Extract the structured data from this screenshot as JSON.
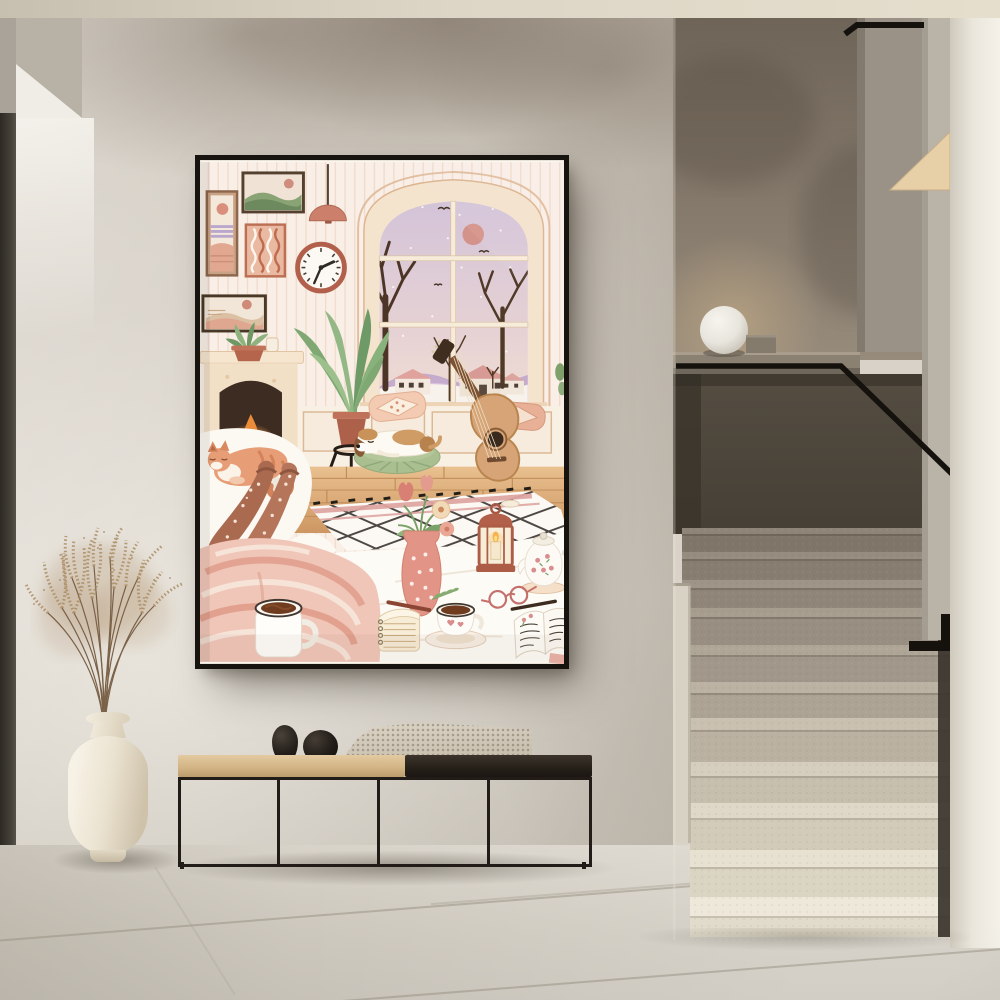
{
  "meta": {
    "description": "Interior hallway photograph: black-framed cozy living-room illustration hanging on a plaster wall above a metal bench, cream vase with dried pampas grass, and a terrazzo staircase with black handrail and white globe lamp"
  },
  "palette": {
    "wall": "#d8d2c9",
    "soffitGrey": "#b7b1a6",
    "soffitWhite": "#f0ede6",
    "doorFrame": "#3b382f",
    "ceiling": "#ddd5c5",
    "frame": "#17140f",
    "artBase": "#faf6ef",
    "artPink": "#e8a898",
    "artTerracotta": "#bd6f54",
    "artGreen": "#7fa873",
    "artPurple": "#c9b7d8",
    "artBrown": "#8a5c38",
    "stairUpperWall": "#75695c",
    "stairPanel": "#4b443a",
    "ledge": "#8b8173",
    "lampWhite": "#f2efe9",
    "handrail": "#16130f",
    "stepDark": "#7f7568",
    "stepLight": "#ede8d9",
    "rightWall": "#f0ece3",
    "floor": "#d5d0c6",
    "benchWood": "#d5b98c",
    "benchMetal": "#211c17",
    "knitThrow": "#cfc6b7",
    "stoneDecor": "#1f1b17",
    "vase": "#ece4d3",
    "pampas": "#b0946f"
  },
  "scene": {
    "ceiling_label": "ceiling beam",
    "wall_label": "warm grey plaster wall",
    "door_label": "dark door frame edge",
    "poster_label": "black-framed art print: cozy pink living room with winter window",
    "poster_items": [
      "gallery pictures",
      "wavy pattern art",
      "pendant lamp",
      "wall clock",
      "arched window with snowy view",
      "fireplace with fire",
      "mantel succulent",
      "potted plant on stand",
      "sleeping beagle on cushion",
      "acoustic guitar",
      "wood floor",
      "lattice rug",
      "person with cozy socks under blanket",
      "sleeping cat",
      "hot chocolate mug",
      "tulip vase",
      "candle lantern",
      "teapot",
      "coffee cup",
      "reading glasses",
      "open journal",
      "notebook and pen"
    ],
    "staircase_label": "terrazzo staircase with black metal handrail",
    "lamp_label": "white globe lamp on concrete ledge",
    "bench_label": "black metal bench with wooden seat, knit throw and two stone decor pieces",
    "vase_label": "cream ceramic vase with dried pampas grass",
    "floor_label": "large stone tile floor"
  }
}
